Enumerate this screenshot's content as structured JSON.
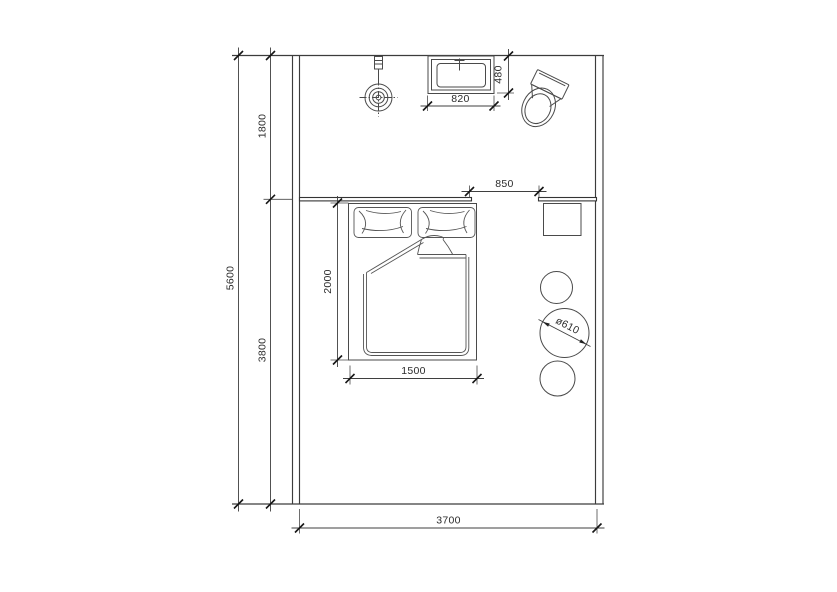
{
  "drawing": {
    "type": "architectural-floor-plan",
    "room": "bedroom-suite-plan"
  },
  "dimensions": {
    "overall_depth": "5600",
    "upper_bay_depth": "1800",
    "lower_bay_depth": "3800",
    "overall_width": "3700",
    "opening_width": "850",
    "basin_width": "820",
    "basin_depth": "480",
    "bed_length": "2000",
    "bed_width": "1500",
    "table_diameter": "ø610"
  },
  "colors": {
    "background": "#ffffff",
    "line": "#3c3c3c",
    "dimension_text": "#2b2b2b"
  }
}
